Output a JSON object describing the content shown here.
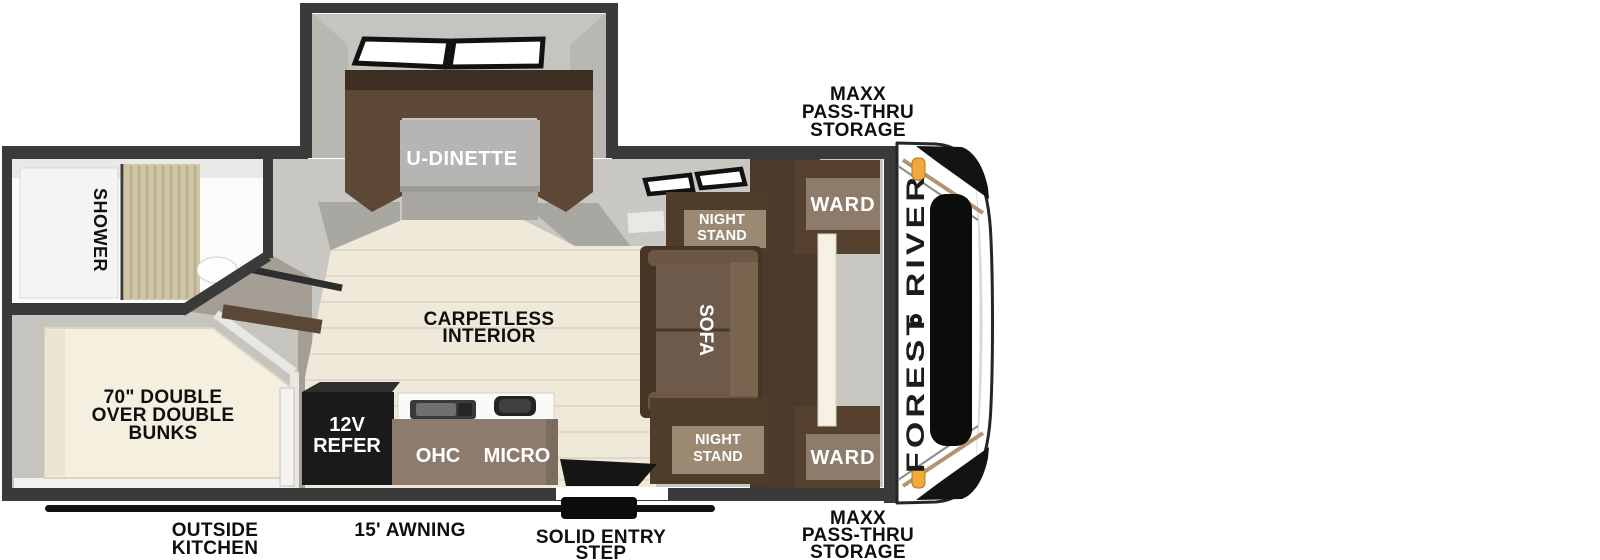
{
  "floorplan": {
    "brand": "FOREST RIVER",
    "rooms": {
      "shower": "SHOWER",
      "bunks": [
        "70\" DOUBLE",
        "OVER DOUBLE",
        "BUNKS"
      ],
      "dinette": "U-DINETTE",
      "interior": [
        "CARPETLESS",
        "INTERIOR"
      ],
      "sofa": "SOFA",
      "night_stand_top": [
        "NIGHT",
        "STAND"
      ],
      "night_stand_bottom": [
        "NIGHT",
        "STAND"
      ],
      "ward_top": "WARD",
      "ward_bottom": "WARD",
      "refer": [
        "12V",
        "REFER"
      ],
      "ohc": "OHC",
      "micro": "MICRO"
    },
    "callouts": {
      "storage_top": [
        "MAXX",
        "PASS-THRU",
        "STORAGE"
      ],
      "storage_bottom": [
        "MAXX",
        "PASS-THRU",
        "STORAGE"
      ],
      "outside_kitchen": [
        "OUTSIDE",
        "KITCHEN"
      ],
      "awning": "15' AWNING",
      "entry_step": [
        "SOLID ENTRY",
        "STEP"
      ]
    },
    "colors": {
      "wall": "#3a3a3a",
      "floor_gray": "#c9c7c2",
      "floor_wood": "#efe9da",
      "hall_gray": "#a49e95",
      "furniture_brown_dark": "#4a3a2b",
      "furniture_brown": "#5d4836",
      "furniture_face": "#9b8974",
      "bed_cream": "#f4efdf",
      "appliance_black": "#1a1a1a",
      "marker_amber": "#f2a83b",
      "stripe_tan": "#b2946f",
      "label_black": "#0f0f0f",
      "label_white": "#ffffff"
    }
  }
}
